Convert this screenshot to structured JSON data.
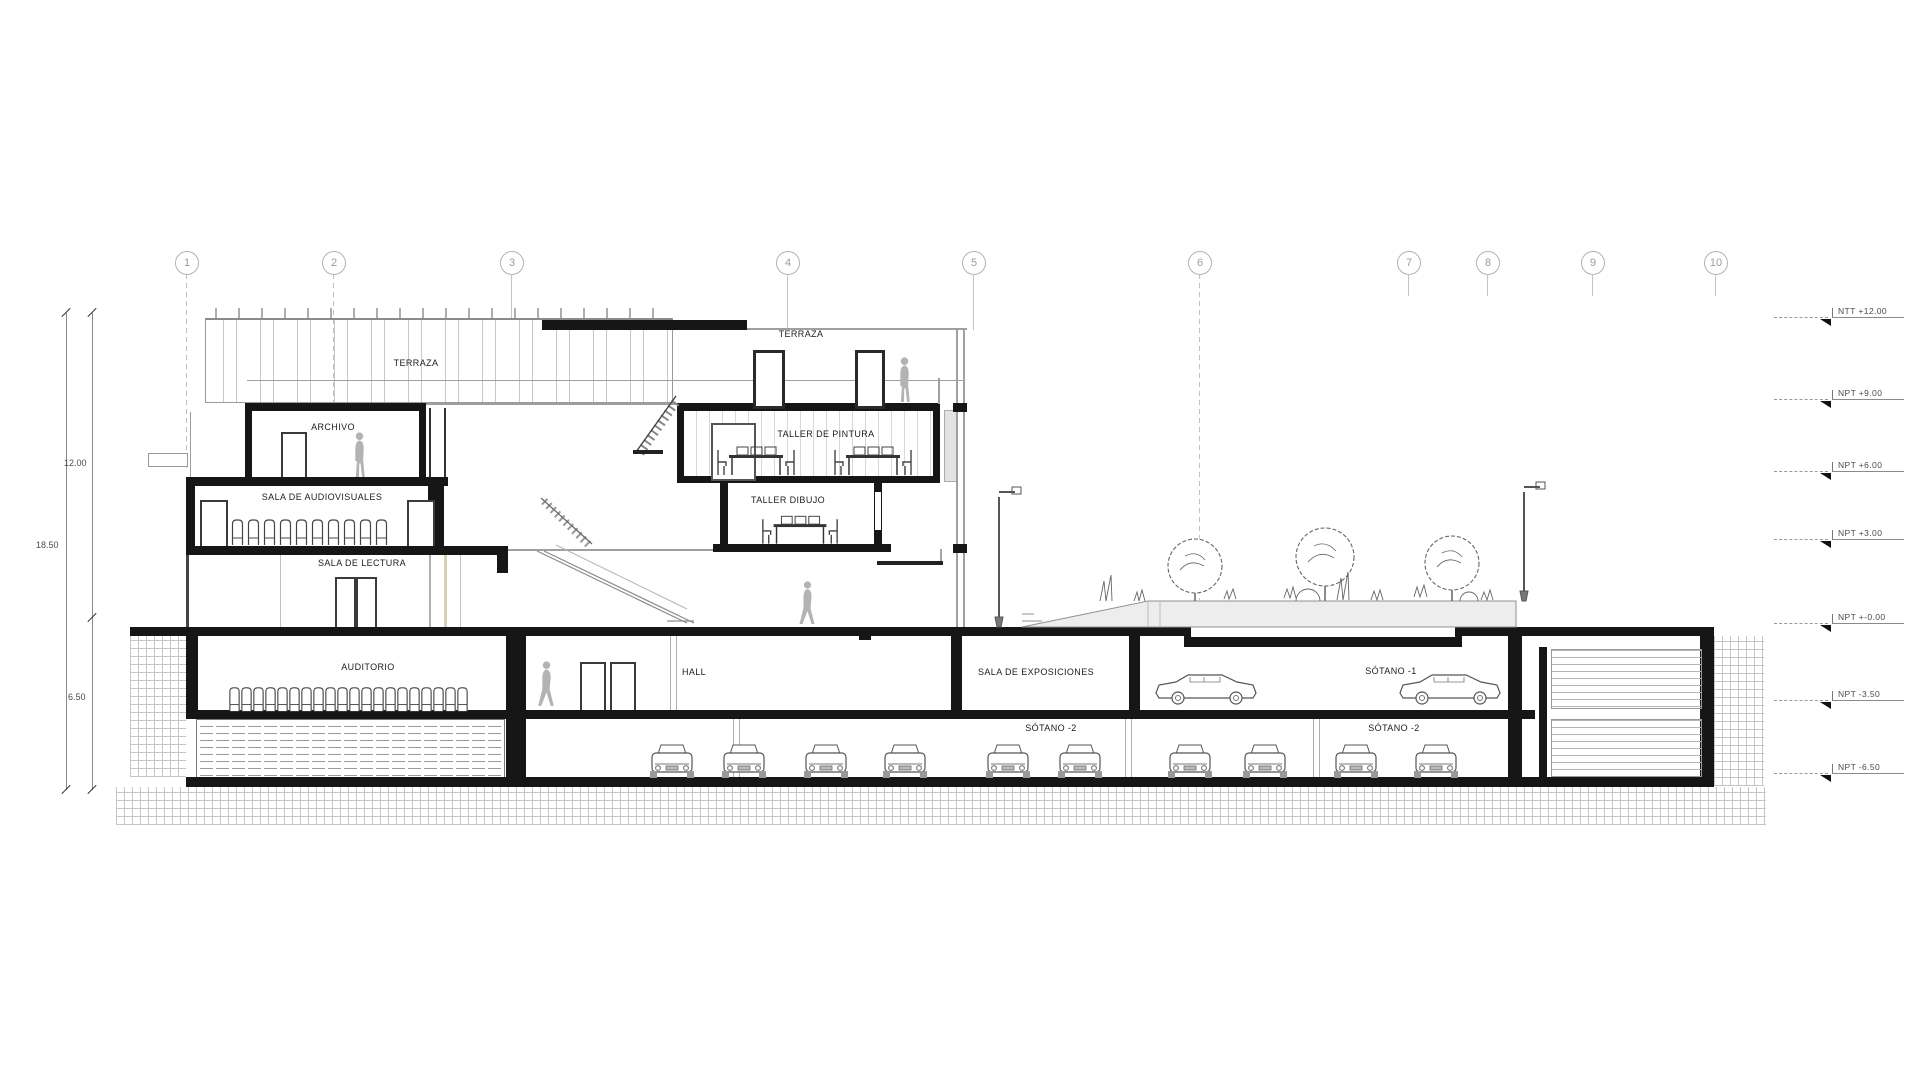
{
  "drawing": {
    "type": "architectural-section",
    "grid_axes": [
      {
        "label": "1"
      },
      {
        "label": "2"
      },
      {
        "label": "3"
      },
      {
        "label": "4"
      },
      {
        "label": "5"
      },
      {
        "label": "6"
      },
      {
        "label": "7"
      },
      {
        "label": "8"
      },
      {
        "label": "9"
      },
      {
        "label": "10"
      }
    ],
    "levels": [
      {
        "label": "NTT +12.00"
      },
      {
        "label": "NPT +9.00"
      },
      {
        "label": "NPT +6.00"
      },
      {
        "label": "NPT +3.00"
      },
      {
        "label": "NPT +-0.00"
      },
      {
        "label": "NPT -3.50"
      },
      {
        "label": "NPT -6.50"
      }
    ],
    "dimensions": [
      {
        "label": "12.00"
      },
      {
        "label": "18.50"
      },
      {
        "label": "6.50"
      }
    ],
    "rooms": [
      {
        "id": "terraza-left",
        "label": "TERRAZA"
      },
      {
        "id": "archivo",
        "label": "ARCHIVO"
      },
      {
        "id": "sala-audiovisuales",
        "label": "SALA DE AUDIOVISUALES"
      },
      {
        "id": "sala-lectura",
        "label": "SALA DE LECTURA"
      },
      {
        "id": "auditorio",
        "label": "AUDITORIO"
      },
      {
        "id": "terraza-right",
        "label": "TERRAZA"
      },
      {
        "id": "taller-pintura",
        "label": "TALLER DE PINTURA"
      },
      {
        "id": "taller-dibujo",
        "label": "TALLER DIBUJO"
      },
      {
        "id": "hall",
        "label": "HALL"
      },
      {
        "id": "sala-exposiciones",
        "label": "SALA DE EXPOSICIONES"
      },
      {
        "id": "sotano-1",
        "label": "SÓTANO -1"
      },
      {
        "id": "sotano-2-left",
        "label": "SÓTANO -2"
      },
      {
        "id": "sotano-2-right",
        "label": "SÓTANO -2"
      }
    ],
    "colors": {
      "section_cut": "#161616",
      "light_line": "#9f9f9f",
      "figure_gray": "#b3b3b3",
      "planter_fill": "#ededed"
    }
  }
}
